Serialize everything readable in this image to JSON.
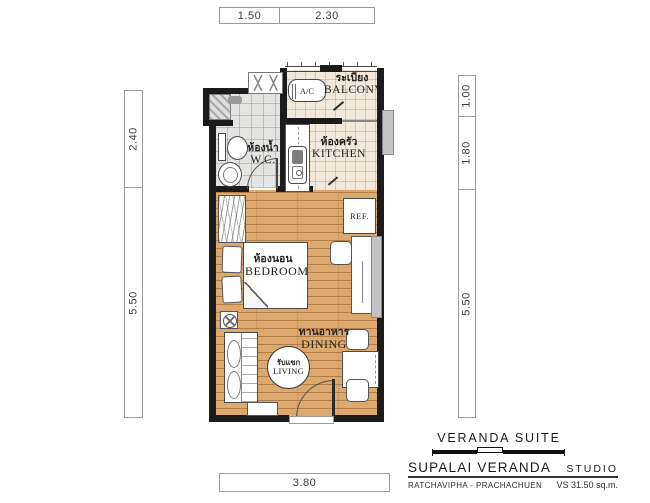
{
  "dimensions": {
    "top": [
      "1.50",
      "2.30"
    ],
    "left": [
      "2.40",
      "5.50"
    ],
    "right": [
      "1.00",
      "1.80",
      "5.50"
    ],
    "bottom": [
      "3.80"
    ]
  },
  "rooms": {
    "balcony": {
      "thai": "ระเบียง",
      "en": "BALCONY"
    },
    "wc": {
      "thai": "ห้องน้ำ",
      "en": "W.C."
    },
    "kitchen": {
      "thai": "ห้องครัว",
      "en": "KITCHEN"
    },
    "bedroom": {
      "thai": "ห้องนอน",
      "en": "BEDROOM"
    },
    "dining": {
      "thai": "ทานอาหาร",
      "en": "DINING"
    },
    "living": {
      "thai": "รับแขก",
      "en": "LIVING"
    }
  },
  "appliances": {
    "ac": "A/C",
    "ref": "REF."
  },
  "title_block": {
    "suite": "VERANDA SUITE",
    "project": "SUPALAI VERANDA",
    "unit_type": "STUDIO",
    "location": "RATCHAVIPHA - PRACHACHUEN",
    "area": "VS 31.50 sq.m."
  },
  "colors": {
    "wall": "#1b1b1b",
    "wood-floor": "#dda96f",
    "tile-beige": "#f3e9da",
    "tile-gray": "#e4e4e2",
    "cabinet-gray": "#c4c4c4",
    "dim-text": "#3a3a3a"
  }
}
